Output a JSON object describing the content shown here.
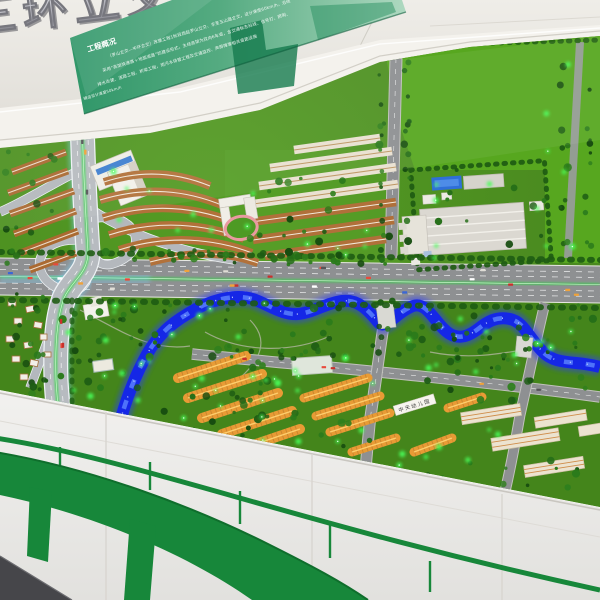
{
  "photo": {
    "caption": "Architectural scale model of an elevated ring-road interchange and riverside district, displayed on a wall-mounted model table in an exhibition room"
  },
  "signage": {
    "metal_sign": {
      "text": "三环立交文"
    },
    "banner": {
      "title": "工程概况",
      "lines": [
        "（罗山立交—中环立交）改建工程1标段西起罗山立交、东至五山路立交，设计速度60km/h，沿线",
        "采用“高架快速路＋地面道路”的建设形式，主线高架为双向6车道，含交通标志标线、信号灯、照明、",
        "排水改建、道路工程、桥梁工程，雨污水排管工程及交通监控、声屏障等相关道路设施"
      ],
      "side_note": "辅道设计速度50km/h"
    },
    "building_sign": "中天幼儿园"
  },
  "model_features": {
    "interchange": "multi-level expressway interchange with loop ramps",
    "river": "illuminated blue meandering river",
    "main_road": "six-lane arterial road crossing the model",
    "residential": "terraced housing rows with brown and cream roofs",
    "industrial": "warehouse compound with blue pond",
    "lit_buildings": "amber illuminated timber-roof building clusters",
    "leds": "green tree lights scattered across the model"
  },
  "colors": {
    "wall": "#e4e1db",
    "banner_green": "#2f9668",
    "turf": "#4e9222",
    "lawn_bright": "#57a71f",
    "park_dark": "#44851b",
    "river_blue": "#1527e6",
    "road_gray": "#8e9092",
    "expressway_glow": "#7fd9ff",
    "median_green": "#35d649",
    "roof_brown": "#b0703a",
    "gold_roof": "#e89b35",
    "led_green": "#49ff5a",
    "viaduct_graphic": "#17873a",
    "floor": "#46464a"
  }
}
